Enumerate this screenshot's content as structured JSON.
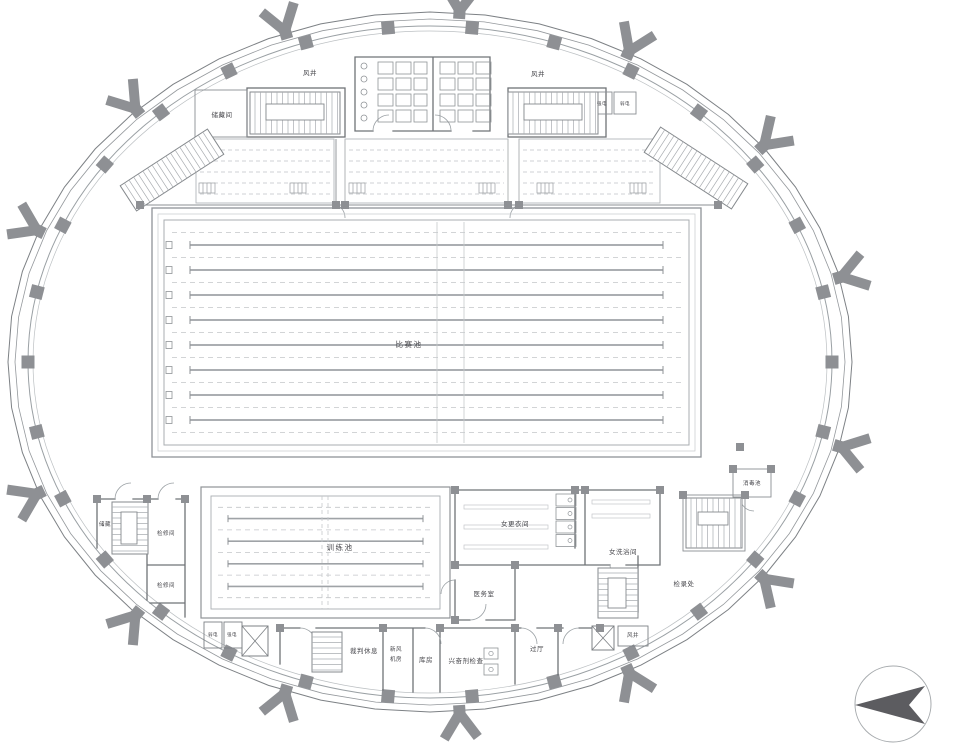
{
  "labels": {
    "storage_room_top": "储藏间",
    "air_shaft_top_left": "风井",
    "air_shaft_top_right": "风井",
    "strong_power_top": "强电",
    "weak_power_top": "弱电",
    "competition_pool": "比赛池",
    "training_pool": "训练池",
    "storage_left": "储藏",
    "maintenance_room_1": "检修间",
    "maintenance_room_2": "检修间",
    "weak_power_bottom": "弱电",
    "strong_power_bottom": "强电",
    "referee_lounge": "裁判休息",
    "fresh_air_line1": "新风",
    "fresh_air_line2": "机房",
    "store_room": "库房",
    "doping_control": "兴奋剂检查",
    "vestibule": "过厅",
    "women_changing_room": "女更衣间",
    "women_shower_room": "女洗浴间",
    "medical_room": "医务室",
    "call_room": "检录处",
    "disinfection_pool": "消毒池",
    "air_shaft_bottom_right": "风井"
  },
  "colors": {
    "wall": "#6f7377",
    "pool_line": "#a9adb1",
    "dashed": "#c3c6c9",
    "column": "#8e9094",
    "arrow": "#5c5c60",
    "text": "#45454a"
  },
  "compass": {
    "icon": "north-arrow",
    "style": "circle-with-left-pointing-arrow"
  }
}
